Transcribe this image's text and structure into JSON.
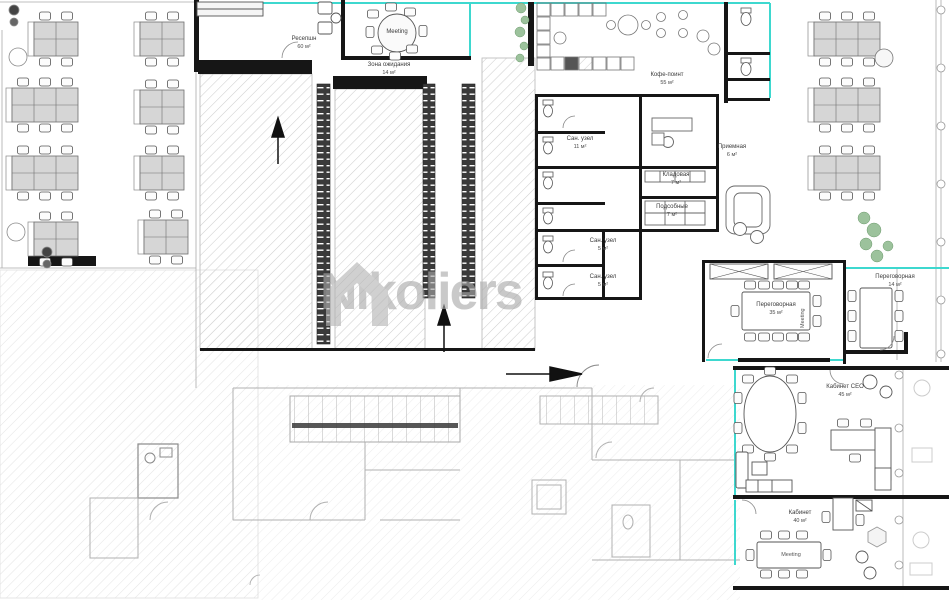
{
  "watermark": {
    "brand": "Nikoliers",
    "color": "#b0b0b0"
  },
  "colors": {
    "boundary_teal": "#3ed8cf",
    "wall_black": "#161616",
    "desk_fill": "#d6d6d6",
    "hatch_gray": "#cfcfcf",
    "plant_green": "#9cc29c",
    "watermark_gray": "#a9a9a9"
  },
  "rooms": {
    "reception": {
      "name": "Ресепшн",
      "area": "60 м²"
    },
    "meeting_top": {
      "tag": "Meeting"
    },
    "waiting": {
      "name": "Зона ожидания",
      "area": "14 м²"
    },
    "coffee_point": {
      "name": "Кофе-поинт",
      "area": "55 м²"
    },
    "wc_large": {
      "name": "Сан. узел",
      "area": "11 м²"
    },
    "anteroom": {
      "name": "Приемная",
      "area": "6 м²"
    },
    "storage": {
      "name": "Кладовая",
      "area": "7 м²"
    },
    "utility": {
      "name": "Подсобные",
      "area": "7 м²"
    },
    "wc_1": {
      "name": "Сан. узел",
      "area": "5 м²"
    },
    "wc_2": {
      "name": "Сан. узел",
      "area": "5 м²"
    },
    "meeting_large": {
      "name": "Переговорная",
      "area": "35 м²",
      "tag": "Meeting"
    },
    "meeting_small": {
      "name": "Переговорная",
      "area": "14 м²"
    },
    "ceo_office": {
      "name": "Кабинет СЕО",
      "area": "45 м²"
    },
    "office": {
      "name": "Кабинет",
      "area": "40 м²",
      "tag": "Meeting"
    }
  }
}
